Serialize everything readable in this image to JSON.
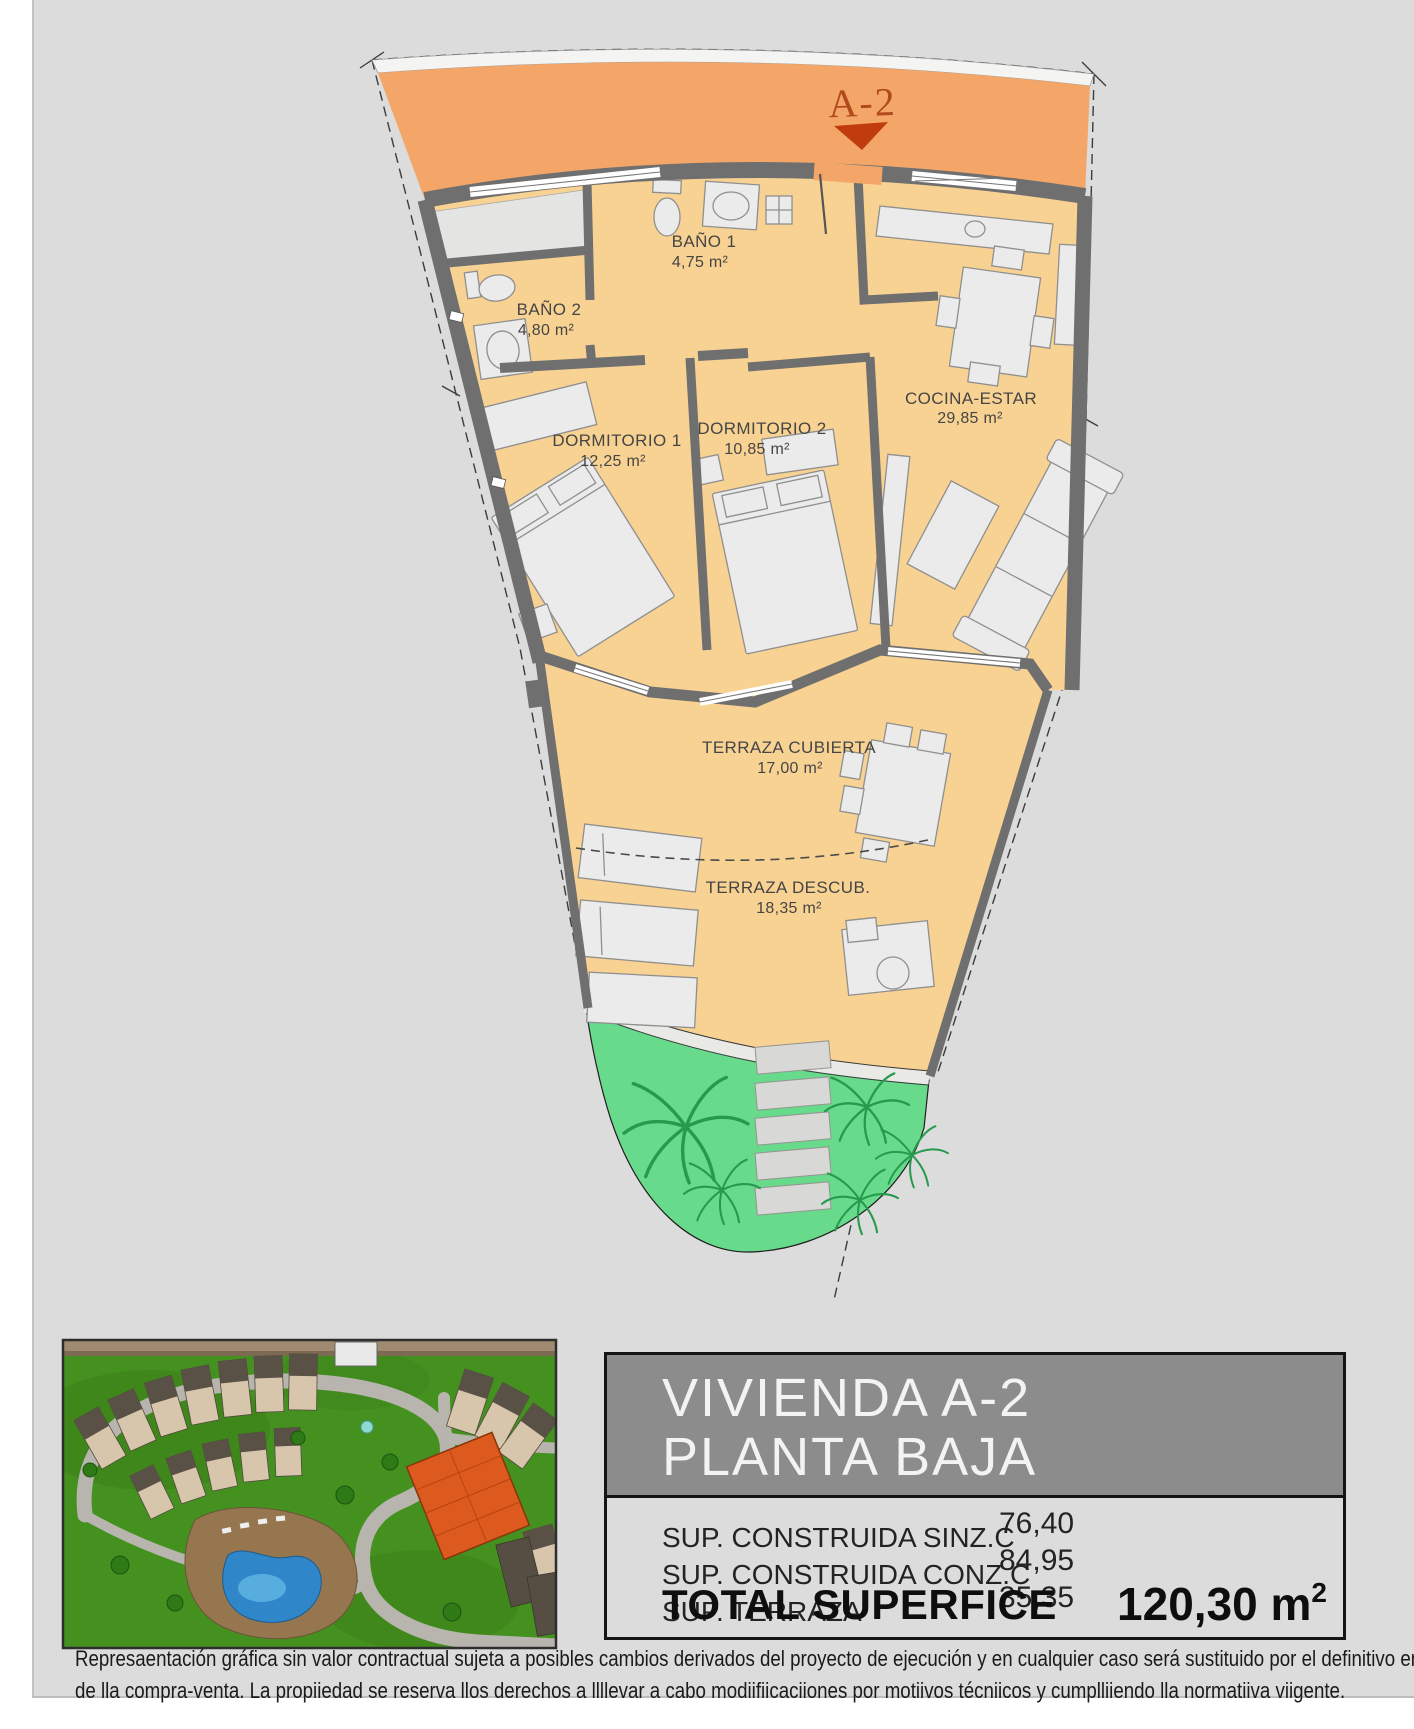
{
  "page": {
    "background": "#dcdcdc",
    "margin_color": "#ffffff"
  },
  "plan": {
    "marker": {
      "label": "A-2",
      "color": "#b24a1e",
      "arrow_color": "#c03b0d"
    },
    "colors": {
      "access_band": "#f3a667",
      "floor": "#f8d292",
      "walls": "#6f6f6f",
      "garden": "#68da8c",
      "furniture": "#ebebeb"
    },
    "rooms": [
      {
        "name": "BAÑO 1",
        "area": "4,75 m²"
      },
      {
        "name": "BAÑO 2",
        "area": "4,80 m²"
      },
      {
        "name": "DORMITORIO 1",
        "area": "12,25 m²"
      },
      {
        "name": "DORMITORIO 2",
        "area": "10,85 m²"
      },
      {
        "name": "COCINA-ESTAR",
        "area": "29,85 m²"
      },
      {
        "name": "TERRAZA CUBIERTA",
        "area": "17,00 m²"
      },
      {
        "name": "TERRAZA DESCUB.",
        "area": "18,35 m²"
      }
    ]
  },
  "title_block": {
    "line1": "VIVIENDA A-2",
    "line2": "PLANTA BAJA",
    "rows": [
      {
        "label": "SUP. CONSTRUIDA SINZ.C",
        "value": "76,40"
      },
      {
        "label": "SUP. CONSTRUIDA CONZ.C",
        "value": "84,95"
      },
      {
        "label": "SUP. TERRAZA",
        "value": "35,35"
      }
    ],
    "total_label": "TOTAL SUPERFICE",
    "total_value": "120,30 m",
    "total_value_sup": "2"
  },
  "disclaimer": {
    "line1": "Represaentación gráfica sin valor contractual sujeta a posibles cambios derivados del proyecto de ejecución y en cualquier caso será sustituido por el definitivo en",
    "line2": "de lla compra-venta. La propiiedad se reserva llos derechos a llllevar a cabo modiifiicaciiones por motiivos técniicos y cumplliiendo lla normatiiva viigente."
  }
}
